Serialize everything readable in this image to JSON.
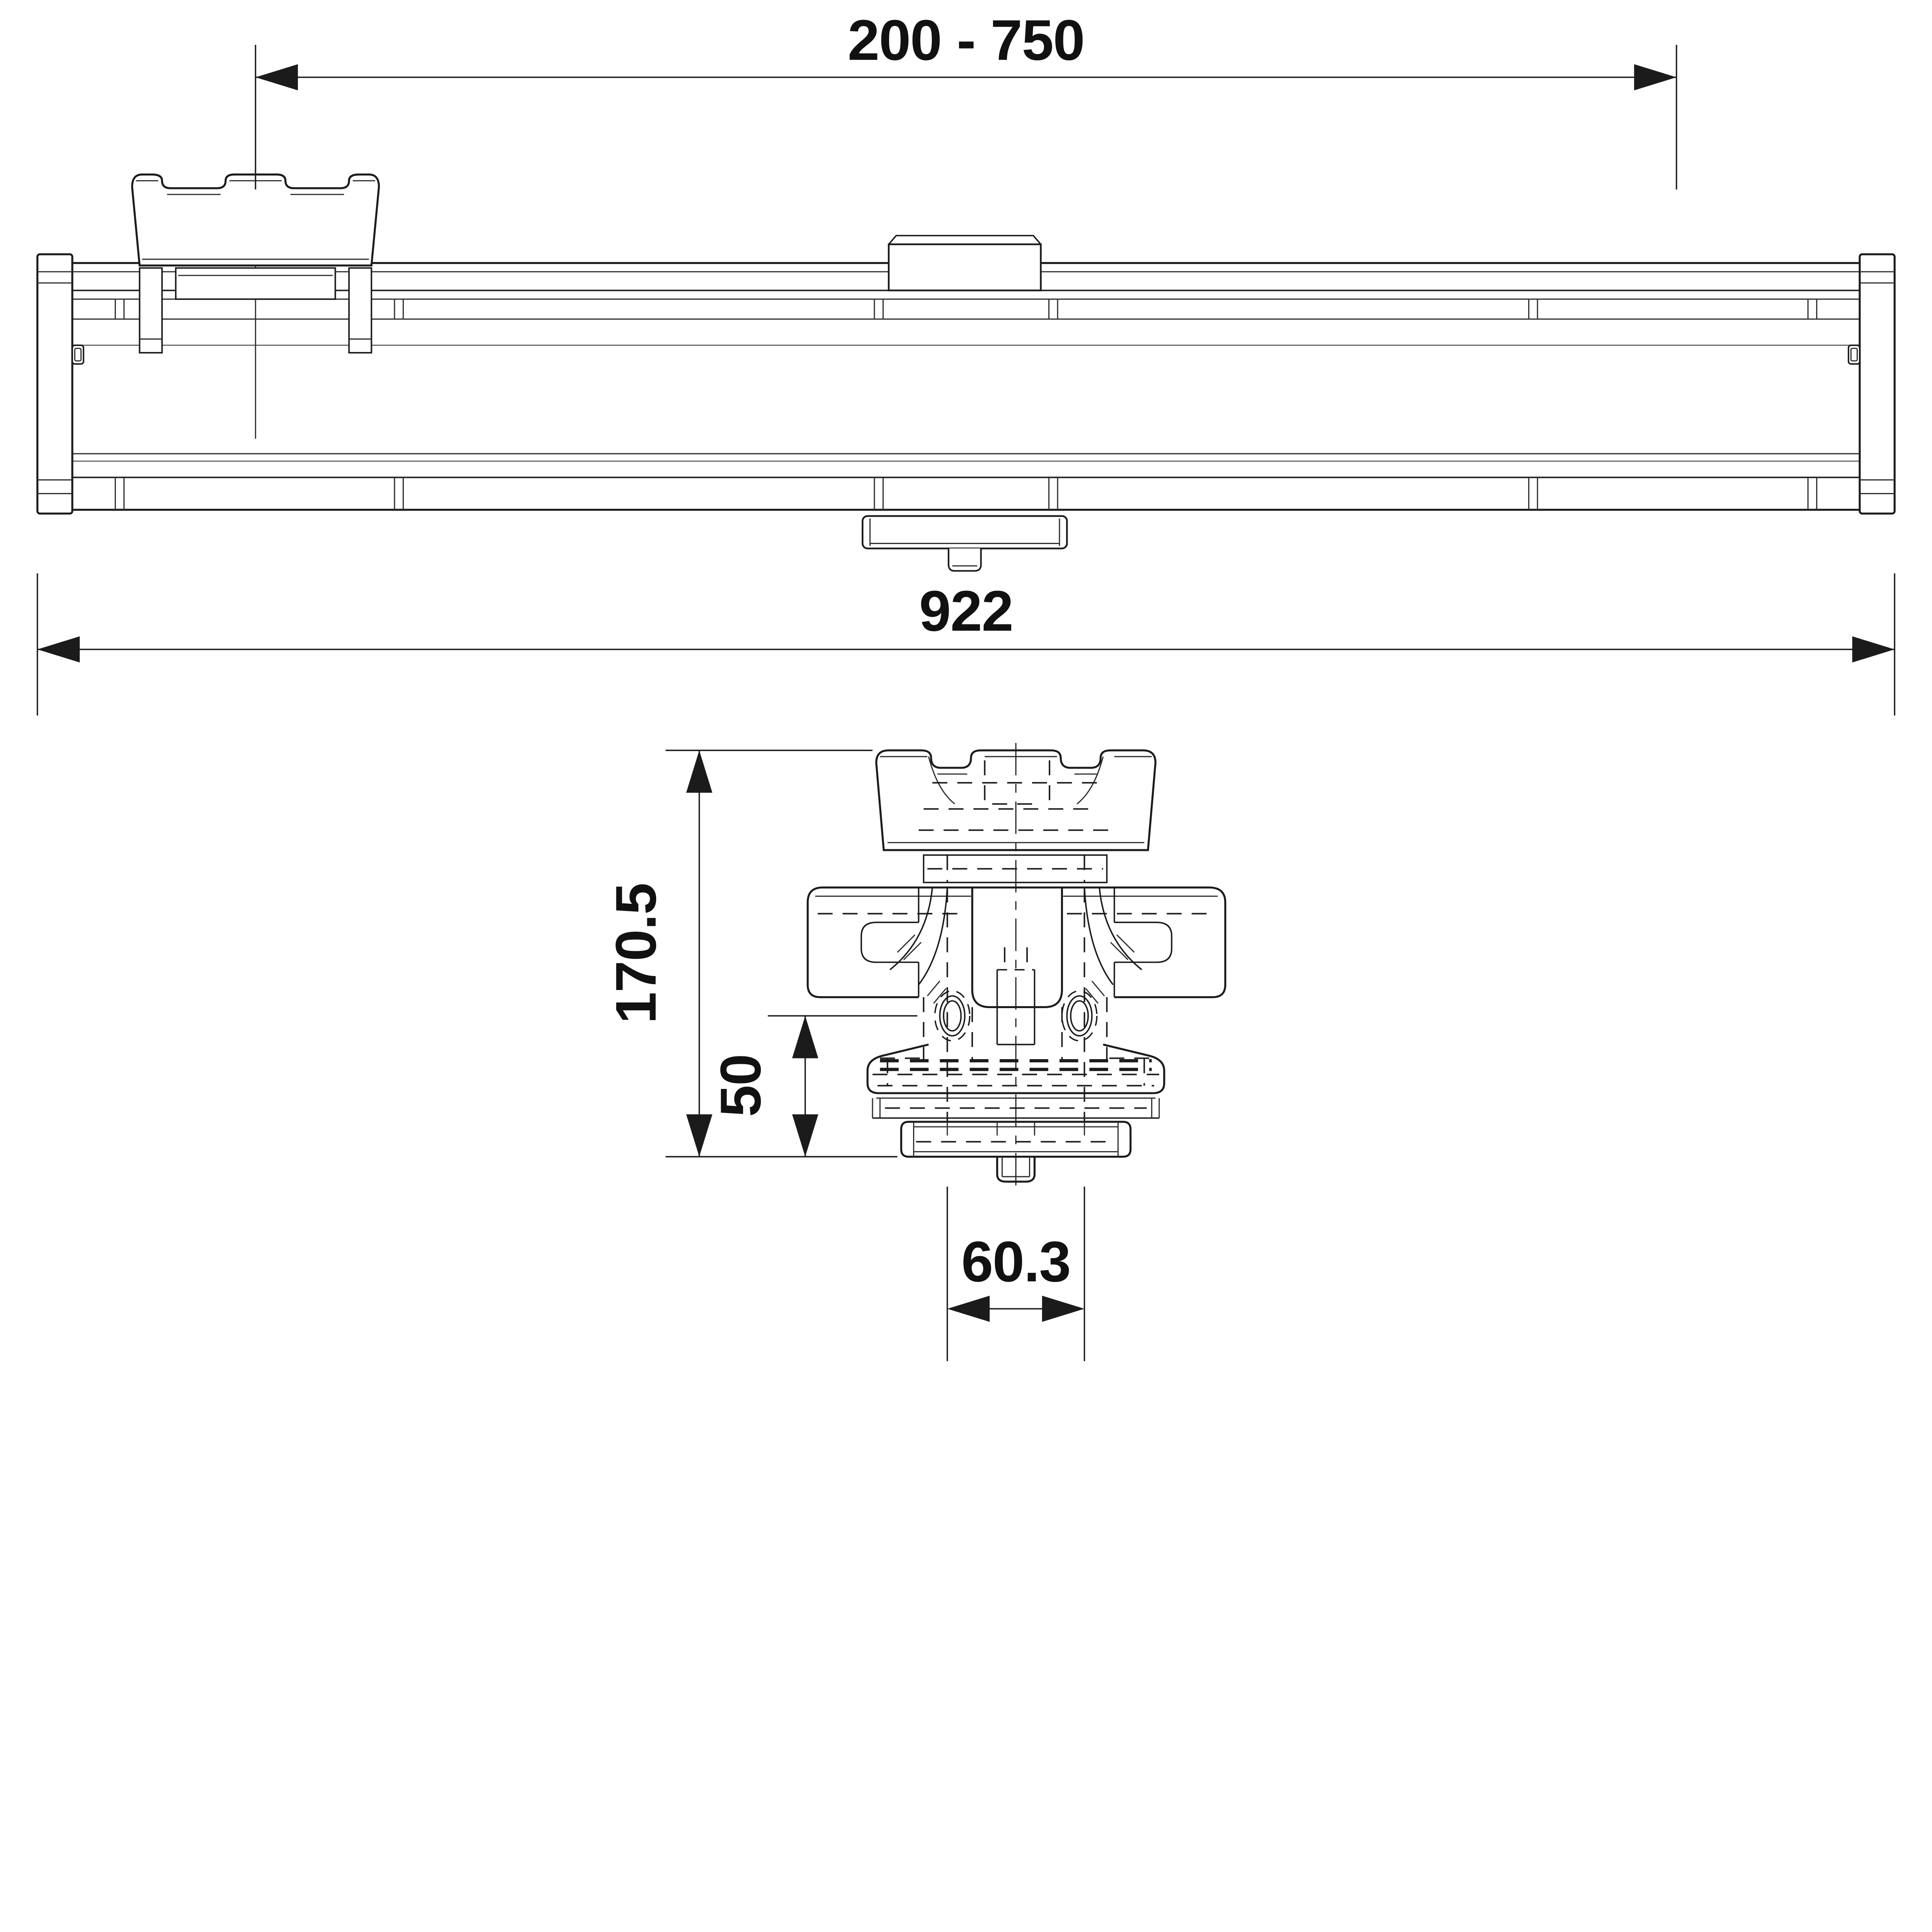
{
  "colors": {
    "background": "#ffffff",
    "line": "#1b1b1b",
    "text": "#111111"
  },
  "dimensions": {
    "bracket_spacing": "200 - 750",
    "overall_length": "922",
    "overall_height": "170.5",
    "base_offset": "50",
    "tube_width": "60.3"
  }
}
